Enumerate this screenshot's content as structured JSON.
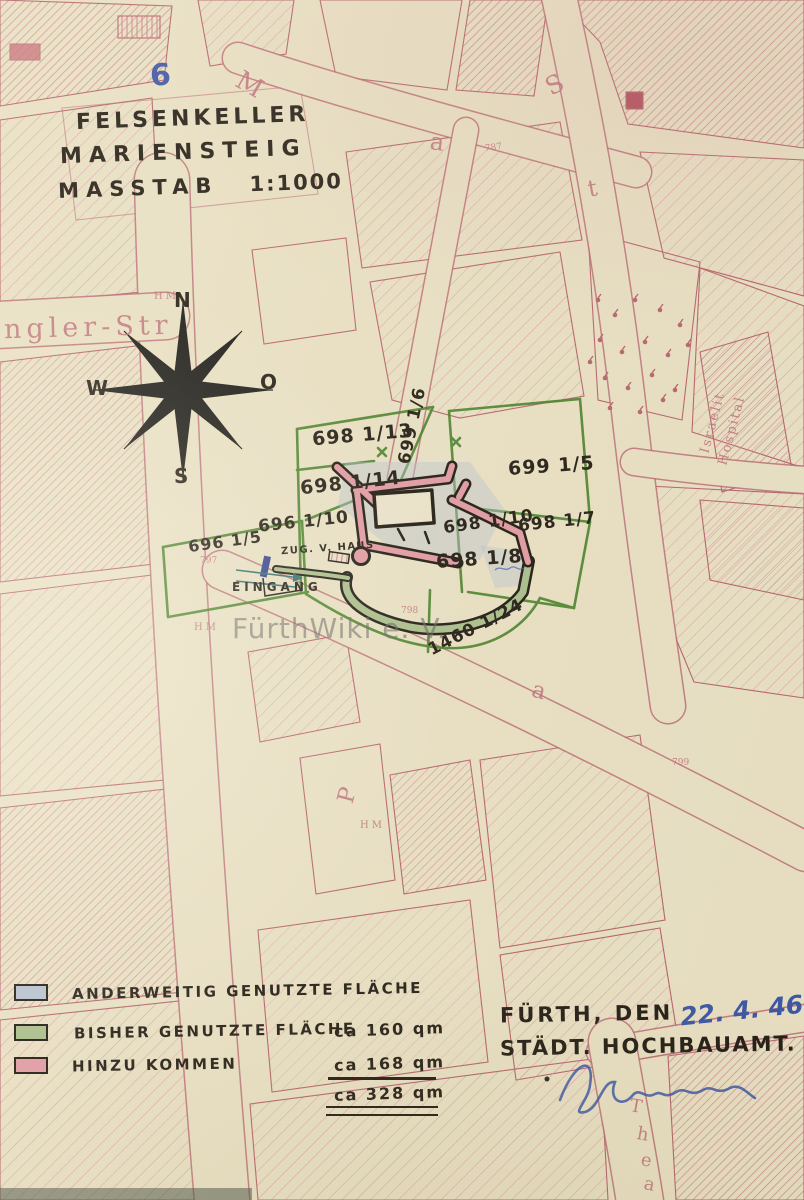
{
  "document": {
    "page_number": "6",
    "title_line1": "FELSENKELLER",
    "title_line2": "MARIENSTEIG",
    "scale_label": "MASSTAB",
    "scale_value": "1:1000"
  },
  "compass": {
    "north": "N",
    "east": "O",
    "south": "S",
    "west": "W"
  },
  "watermark": "FürthWiki e. V.",
  "parcel_labels": {
    "p698_13": "698 1/13",
    "p698_14": "698 1/14",
    "p699_6": "699 1/6",
    "p699_5": "699 1/5",
    "p698_10": "698 1/10",
    "p698_7": "698 1/7",
    "p698_8": "698 1/8",
    "p696_10": "696 1/10",
    "p696_5": "696 1/5",
    "p1460_24": "1460 1/24"
  },
  "annotations": {
    "access": "ZUG. V. HAUS",
    "entrance": "EINGANG"
  },
  "street_labels": {
    "ngler_str": "ngler-Str",
    "m": "M",
    "a1": "a",
    "s": "S",
    "t1": "t",
    "p": "P",
    "a2": "a",
    "thea_t": "T",
    "thea_h": "h",
    "thea_e": "e",
    "thea_a": "a",
    "hospital_line1": "Israelit",
    "hospital_line2": "Hospital"
  },
  "survey_marks": {
    "hm1": "HM",
    "hm2": "HM",
    "hm3": "HM",
    "n787": "787",
    "n797": "797",
    "n798": "798",
    "n799": "799"
  },
  "legend": {
    "items": [
      {
        "label": "ANDERWEITIG GENUTZTE FLÄCHE",
        "color": "#b7c3d6"
      },
      {
        "label": "BISHER GENUTZTE FLÄCHE",
        "value": "ca 160 qm",
        "color": "#a9c08d"
      },
      {
        "label": "HINZU KOMMEN",
        "value": "ca 168 qm",
        "color": "#e39aa6"
      }
    ],
    "total_value": "ca 328 qm"
  },
  "footer": {
    "place": "FÜRTH, DEN",
    "date": "22. 4. 46",
    "office": "STÄDT. HOCHBAUAMT."
  },
  "colors": {
    "paper": "#ece4c9",
    "map_ink": "#b5606d",
    "parcel_green": "#3f7d22",
    "hand_black": "#1a150f",
    "ink_blue": "#3552a8",
    "wash_blue": "#b7c3d6",
    "wash_green": "#a9c08d",
    "wash_pink": "#e39aa6"
  }
}
